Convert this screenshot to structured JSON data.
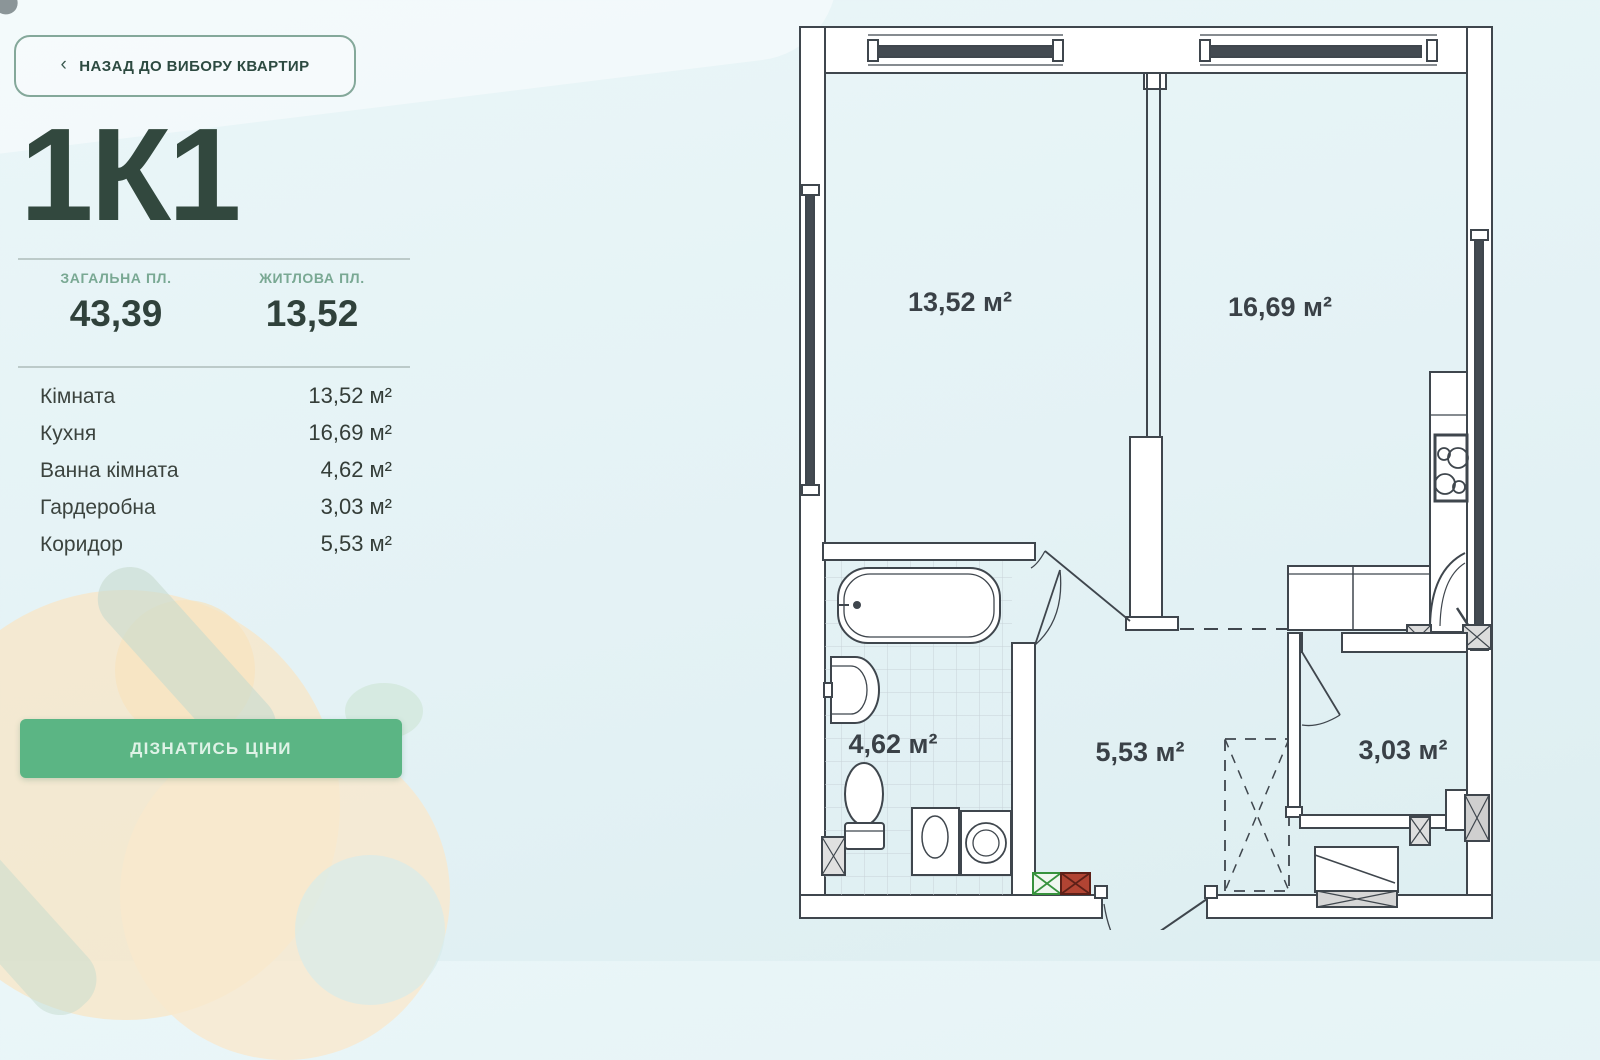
{
  "back_button": {
    "chevron": "‹",
    "label": "НАЗАД ДО ВИБОРУ КВАРТИР"
  },
  "apartment": {
    "title": "1К1"
  },
  "stats": {
    "items": [
      {
        "label": "ЗАГАЛЬНА ПЛ.",
        "value": "43,39"
      },
      {
        "label": "ЖИТЛОВА ПЛ.",
        "value": "13,52"
      }
    ]
  },
  "rooms": {
    "items": [
      {
        "name": "Кімната",
        "area": "13,52 м²"
      },
      {
        "name": "Кухня",
        "area": "16,69 м²"
      },
      {
        "name": "Ванна кімната",
        "area": "4,62 м²"
      },
      {
        "name": "Гардеробна",
        "area": "3,03 м²"
      },
      {
        "name": "Коридор",
        "area": "5,53 м²"
      }
    ]
  },
  "cta": {
    "label": "ДІЗНАТИСЬ ЦІНИ"
  },
  "plan": {
    "labels": {
      "living_room": "13,52 м²",
      "kitchen": "16,69 м²",
      "bathroom": "4,62 м²",
      "corridor": "5,53 м²",
      "wardrobe": "3,03 м²"
    }
  },
  "colors": {
    "accent_green": "#5bb584",
    "label_green": "#79a893",
    "title_dark": "#32483e",
    "plan_line": "#3f464d",
    "shaft_green": "#37923d",
    "shaft_red": "#b14433"
  }
}
